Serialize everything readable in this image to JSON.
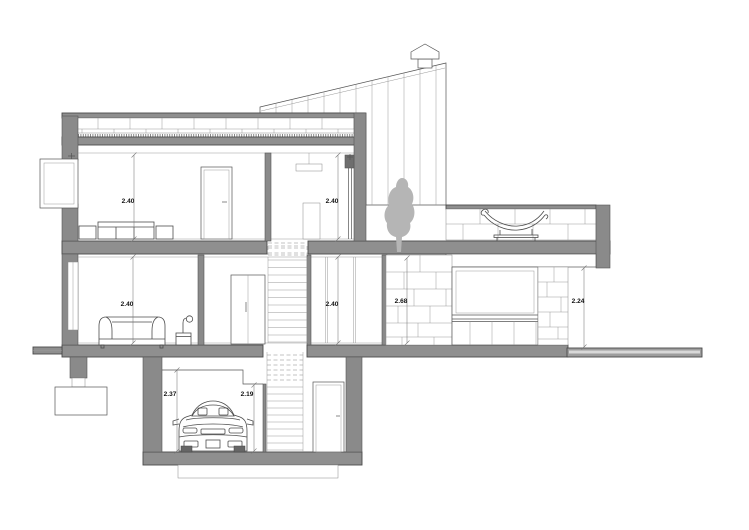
{
  "title": "House cross-section drawing",
  "colors": {
    "background": "#ffffff",
    "wall": "#8a8a8a",
    "slab": "#8f8f8f",
    "line": "#555555",
    "silhouette": "#b5b5b5",
    "text": "#111111"
  },
  "dimensions": {
    "upper_left": "2.40",
    "upper_right": "2.40",
    "ground_left": "2.40",
    "ground_middle": "2.40",
    "ground_masonry": "2.68",
    "exterior_right": "2.24",
    "basement_garage": "2.37",
    "basement_step": "2.19"
  }
}
